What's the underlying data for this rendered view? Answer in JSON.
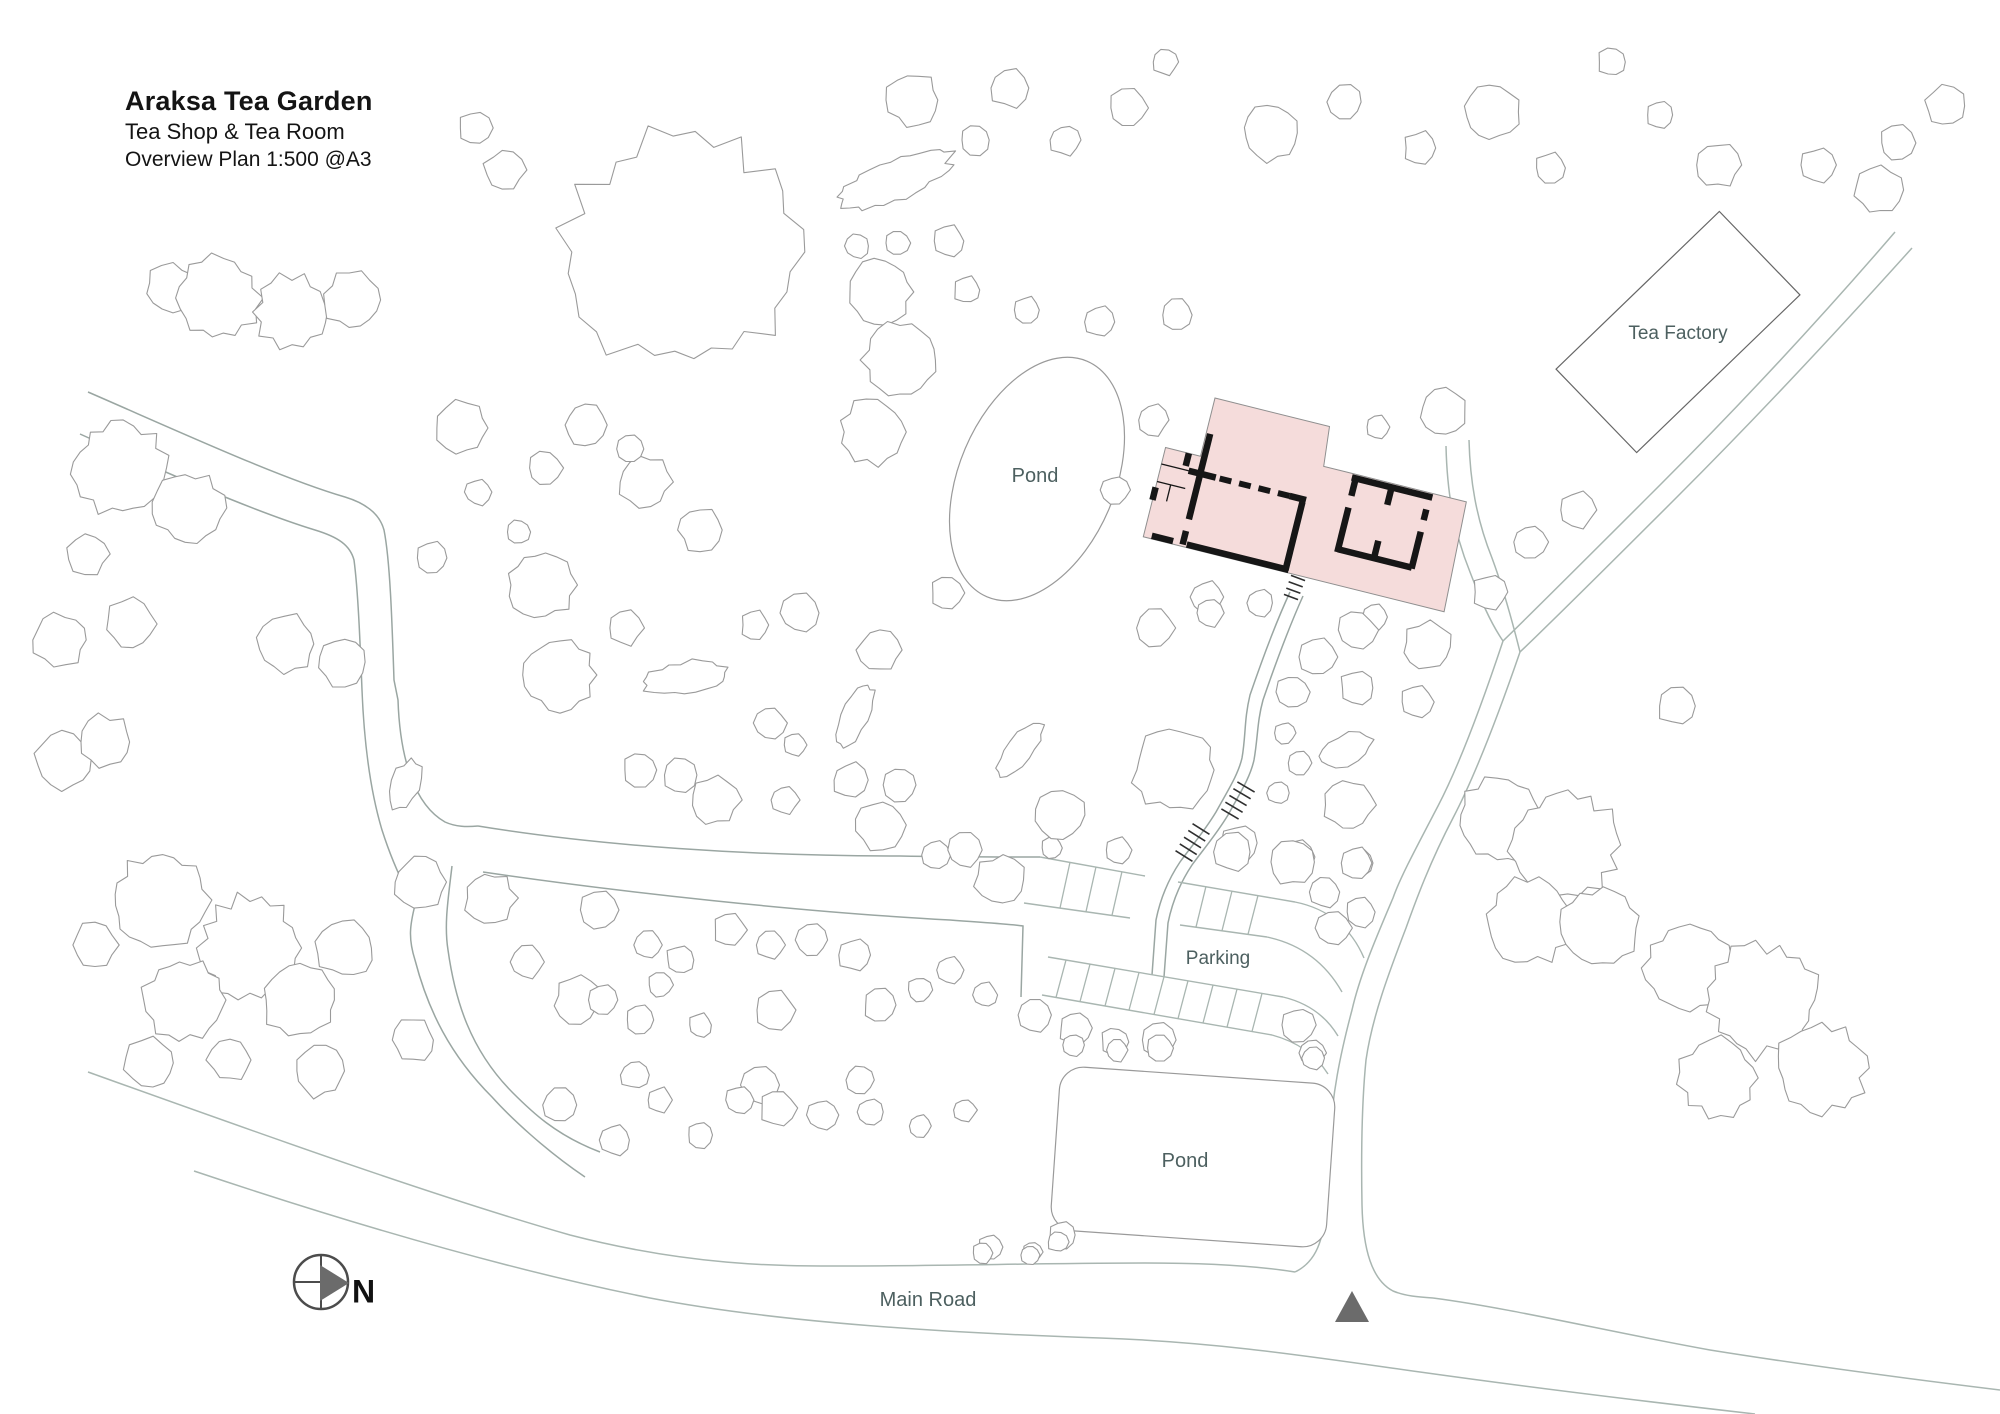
{
  "title_block": {
    "line1": "Araksa Tea Garden",
    "line2": "Tea Shop & Tea Room",
    "line3": "Overview Plan 1:500 @A3"
  },
  "colors": {
    "background": "#ffffff",
    "road": "#a9b6b1",
    "trail": "#9aa6a2",
    "tree": "#9a9a9a",
    "pond_outline": "#9a9a9a",
    "building_fill": "#f5dcdb",
    "building_outline": "#8f8f8f",
    "wall": "#161616",
    "hatch": "#2f2f2f",
    "label": "#4d6060",
    "title": "#141414",
    "compass_stroke": "#4c4c4c",
    "compass_fill": "#6b6b6b",
    "factory_outline": "#666666",
    "marker_fill": "#6b6b6b"
  },
  "labels": [
    {
      "name": "pond-upper-label",
      "text": "Pond",
      "x": 1035,
      "y": 482,
      "size": 20
    },
    {
      "name": "pond-lower-label",
      "text": "Pond",
      "x": 1185,
      "y": 1167,
      "size": 20
    },
    {
      "name": "parking-label",
      "text": "Parking",
      "x": 1218,
      "y": 964,
      "size": 19
    },
    {
      "name": "main-road-label",
      "text": "Main Road",
      "x": 928,
      "y": 1306,
      "size": 20
    },
    {
      "name": "tea-factory-label",
      "text": "Tea Factory",
      "x": 1678,
      "y": 339,
      "size": 19
    }
  ],
  "compass": {
    "cx": 321,
    "cy": 1282,
    "r": 27,
    "lines": [
      [
        294,
        1282,
        323,
        1282
      ],
      [
        321,
        1256,
        321,
        1308
      ]
    ],
    "triangle": "320,1265 349,1283 320,1301",
    "letter": "N",
    "letter_x": 352,
    "letter_y": 1294,
    "letter_size": 32
  },
  "entrance_marker": {
    "points": "1335,1322 1352,1291 1369,1322"
  },
  "ponds": {
    "upper": {
      "cx": 1037,
      "cy": 479,
      "rx": 78,
      "ry": 128,
      "rot": 23
    },
    "lower": {
      "cx": 1193,
      "cy": 1157,
      "w": 276,
      "h": 164,
      "rx": 24,
      "rot": 4
    }
  },
  "factory": {
    "cx": 1678,
    "cy": 332,
    "w": 227,
    "h": 116,
    "rot": -44
  },
  "building": {
    "transform": "translate(1215,398) rotate(14)",
    "footprint": "0,0 118,0 122,40 146,40 269,40 274,152 -36,152 -36,60 0,60",
    "walls_thick": [
      "M 4,36 L 4,124",
      "M 4,136 L 4,150",
      "M -8,77 L 20,77",
      "M 96,77 L 113,77",
      "M 110,80 L 110,150",
      "M -28,149 L -6,149",
      "M 8,149 L 113,149",
      "M -12,60 L -12,73",
      "M -36,101 L -36,114",
      "M 152,44 L 235,44",
      "M 156,44 L 156,62",
      "M 156,74 L 156,120",
      "M 156,117 L 232,117",
      "M 232,57 L 232,68",
      "M 232,80 L 232,118",
      "M 193,44 L 193,62",
      "M 193,99 L 193,118"
    ],
    "walls_thin": [
      "M -36,77 L -8,77",
      "M -36,95 L -7,95",
      "M -22,95 L -22,112"
    ],
    "dashed_wall": {
      "d": "M 24,77 L 96,77",
      "dash": "12 8"
    }
  },
  "roads": {
    "paths": [
      {
        "name": "main-road-top-left",
        "d": "M 88,1072 C 250,1130 430,1195 570,1235 C 690,1266 780,1266 835,1266 C 940,1266 1050,1263 1145,1263 C 1210,1263 1258,1266 1295,1272"
      },
      {
        "name": "main-road-top-right",
        "d": "M 1433,1298 C 1510,1308 1610,1332 1710,1350 C 1810,1366 1910,1379 2000,1390"
      },
      {
        "name": "main-road-bottom",
        "d": "M 194,1171 C 340,1220 500,1268 650,1298 C 780,1323 950,1333 1100,1338 C 1220,1342 1320,1358 1420,1372 C 1520,1386 1650,1402 1755,1414"
      },
      {
        "name": "access-road-west-edge",
        "d": "M 1503,641 C 1485,695 1462,760 1438,806 C 1415,850 1400,878 1393,898 C 1376,938 1360,975 1352,1010 C 1340,1055 1332,1095 1330,1140 L 1326,1205"
      },
      {
        "name": "access-road-east-edge",
        "d": "M 1520,652 C 1500,710 1477,772 1453,818 C 1430,862 1416,900 1406,928 C 1388,975 1372,1018 1366,1060 C 1362,1100 1361,1150 1362,1205"
      },
      {
        "name": "junction-flare-left",
        "d": "M 1326,1205 C 1324,1240 1316,1262 1295,1272"
      },
      {
        "name": "junction-flare-right",
        "d": "M 1362,1205 C 1363,1250 1372,1280 1393,1291 C 1405,1296 1418,1297 1433,1298"
      },
      {
        "name": "factory-road-nw-edge",
        "d": "M 1503,641 C 1545,600 1600,545 1660,485 C 1730,415 1815,325 1895,232"
      },
      {
        "name": "factory-road-se-edge",
        "d": "M 1520,652 C 1562,612 1617,557 1677,497 C 1747,427 1832,337 1912,248"
      },
      {
        "name": "building-drive-west",
        "d": "M 1446,446 C 1447,490 1453,530 1470,572 C 1480,598 1490,622 1503,641"
      },
      {
        "name": "building-drive-east",
        "d": "M 1469,440 C 1470,480 1476,518 1492,558 C 1502,585 1510,612 1520,652"
      },
      {
        "name": "west-trail-north-edge",
        "d": "M 88,392 C 180,432 280,478 345,497 C 368,504 380,515 384,530 C 390,560 392,620 394,680 L 398,700 C 400,760 415,805 445,822 C 456,827 467,827 478,826",
        "trail": true
      },
      {
        "name": "west-trail-south-edge",
        "d": "M 80,434 C 160,470 250,510 315,530 C 338,537 350,545 354,560 C 358,590 360,640 362,690 C 364,740 370,790 382,830 C 390,855 400,880 415,905",
        "trail": true
      },
      {
        "name": "west-trail-sw-branch-west",
        "d": "M 415,905 C 410,925 408,938 415,960 C 428,1010 450,1055 492,1097 C 510,1117 545,1150 585,1177",
        "trail": true
      },
      {
        "name": "west-trail-sw-branch-east",
        "d": "M 452,866 C 448,900 444,925 448,950 C 455,1000 470,1050 513,1093 C 530,1110 555,1135 600,1152",
        "trail": true
      },
      {
        "name": "east-branch-top",
        "d": "M 478,826 C 600,846 750,856 900,856 C 950,857 1000,857 1040,857",
        "trail": true
      },
      {
        "name": "east-branch-bottom",
        "d": "M 483,872 C 620,892 800,912 950,920 C 990,923 1010,924 1023,926 L 1021,997",
        "trail": true
      },
      {
        "name": "walkway-left-edge",
        "d": "M 1290,592 C 1277,620 1262,660 1250,695 C 1244,720 1246,735 1242,758 C 1238,775 1228,790 1216,812 C 1204,832 1190,848 1180,862 C 1168,880 1160,900 1156,920 L 1152,975",
        "trail": true
      },
      {
        "name": "walkway-right-edge",
        "d": "M 1303,596 C 1290,625 1275,665 1263,700 C 1257,722 1258,737 1254,760 C 1250,778 1240,793 1228,815 C 1216,835 1202,851 1192,865 C 1180,883 1172,903 1168,923 L 1164,977",
        "trail": true
      }
    ]
  },
  "parking": {
    "edges": [
      "M 1040,857 L 1145,876",
      "M 1178,882 L 1295,902",
      "M 1024,903 L 1130,918",
      "M 1180,925 L 1267,937",
      "M 1048,957 L 1283,997",
      "M 1042,995 L 1272,1035",
      "M 1295,902 C 1330,909 1352,930 1364,958",
      "M 1267,937 C 1300,944 1325,962 1342,992",
      "M 1283,997 C 1308,1003 1326,1016 1338,1036",
      "M 1272,1035 C 1298,1042 1316,1055 1328,1074"
    ],
    "bands": [
      {
        "top": [
          1040,
          857,
          1295,
          902
        ],
        "bottom": [
          1024,
          903,
          1267,
          937
        ],
        "xs": [
          1060,
          1086,
          1112,
          1196,
          1222,
          1248
        ],
        "lean": 10
      },
      {
        "top": [
          1048,
          957,
          1283,
          997
        ],
        "bottom": [
          1042,
          995,
          1272,
          1035
        ],
        "xs": [
          1056,
          1080,
          1105,
          1129,
          1154,
          1178,
          1203,
          1227,
          1252
        ],
        "lean": 10
      }
    ]
  },
  "hatches": [
    {
      "x1": 1246,
      "y1": 787,
      "x2": 1230,
      "y2": 814,
      "n": 5,
      "len": 20
    },
    {
      "x1": 1201,
      "y1": 829,
      "x2": 1184,
      "y2": 856,
      "n": 5,
      "len": 20
    },
    {
      "x1": 1298,
      "y1": 578,
      "x2": 1291,
      "y2": 597,
      "n": 4,
      "len": 15
    },
    {
      "x1": 1302,
      "y1": 516,
      "x2": 1307,
      "y2": 531,
      "n": 4,
      "len": 12
    }
  ],
  "trees": [
    [
      170,
      288,
      24
    ],
    [
      218,
      298,
      40
    ],
    [
      292,
      312,
      36
    ],
    [
      352,
      300,
      28
    ],
    [
      120,
      468,
      46
    ],
    [
      188,
      508,
      34
    ],
    [
      88,
      554,
      20
    ],
    [
      60,
      640,
      26
    ],
    [
      130,
      624,
      24
    ],
    [
      287,
      644,
      28
    ],
    [
      342,
      662,
      24
    ],
    [
      462,
      428,
      26
    ],
    [
      478,
      492,
      13
    ],
    [
      432,
      558,
      16
    ],
    [
      518,
      532,
      12
    ],
    [
      65,
      760,
      28
    ],
    [
      105,
      742,
      26
    ],
    [
      160,
      900,
      46
    ],
    [
      250,
      948,
      50
    ],
    [
      185,
      1000,
      40
    ],
    [
      300,
      1000,
      36
    ],
    [
      345,
      948,
      28
    ],
    [
      95,
      945,
      22
    ],
    [
      150,
      1063,
      24
    ],
    [
      230,
      1060,
      21
    ],
    [
      320,
      1071,
      25
    ],
    [
      413,
      1040,
      21
    ],
    [
      405,
      785,
      14,
      26,
      20
    ],
    [
      420,
      882,
      25
    ],
    [
      490,
      898,
      25
    ],
    [
      527,
      962,
      16
    ],
    [
      578,
      1000,
      23
    ],
    [
      540,
      585,
      33
    ],
    [
      560,
      675,
      36
    ],
    [
      585,
      425,
      21
    ],
    [
      645,
      482,
      25
    ],
    [
      545,
      468,
      17
    ],
    [
      700,
      530,
      21
    ],
    [
      684,
      252,
      114
    ],
    [
      505,
      170,
      20
    ],
    [
      475,
      128,
      17
    ],
    [
      895,
      180,
      60,
      20,
      -22
    ],
    [
      913,
      100,
      26
    ],
    [
      975,
      140,
      15
    ],
    [
      857,
      246,
      12
    ],
    [
      897,
      243,
      12
    ],
    [
      949,
      241,
      15
    ],
    [
      967,
      290,
      13
    ],
    [
      880,
      292,
      32
    ],
    [
      900,
      360,
      36
    ],
    [
      872,
      432,
      32
    ],
    [
      630,
      449,
      14
    ],
    [
      1010,
      88,
      19
    ],
    [
      1065,
      140,
      15
    ],
    [
      1128,
      108,
      19
    ],
    [
      1165,
      62,
      13
    ],
    [
      1270,
      133,
      27
    ],
    [
      1345,
      102,
      17
    ],
    [
      1420,
      148,
      16
    ],
    [
      1492,
      112,
      28
    ],
    [
      1550,
      168,
      15
    ],
    [
      1612,
      62,
      14
    ],
    [
      1660,
      115,
      13
    ],
    [
      1718,
      165,
      22
    ],
    [
      1818,
      165,
      17
    ],
    [
      1897,
      143,
      17
    ],
    [
      1878,
      190,
      23
    ],
    [
      1945,
      106,
      20
    ],
    [
      1027,
      310,
      13
    ],
    [
      1100,
      322,
      15
    ],
    [
      1177,
      315,
      16
    ],
    [
      1153,
      420,
      15
    ],
    [
      1115,
      490,
      14
    ],
    [
      1378,
      427,
      11
    ],
    [
      1443,
      412,
      23
    ],
    [
      1577,
      510,
      18
    ],
    [
      1530,
      542,
      17
    ],
    [
      1490,
      592,
      17
    ],
    [
      1677,
      706,
      19
    ],
    [
      1207,
      597,
      16
    ],
    [
      1260,
      603,
      13
    ],
    [
      1375,
      617,
      13
    ],
    [
      1155,
      628,
      19
    ],
    [
      1210,
      613,
      14
    ],
    [
      1318,
      657,
      18
    ],
    [
      1357,
      630,
      19
    ],
    [
      1427,
      647,
      24
    ],
    [
      1293,
      692,
      16
    ],
    [
      1357,
      688,
      17
    ],
    [
      1417,
      702,
      16
    ],
    [
      1175,
      770,
      40
    ],
    [
      1285,
      733,
      11
    ],
    [
      1300,
      763,
      12
    ],
    [
      1345,
      750,
      28,
      15,
      -20
    ],
    [
      1278,
      793,
      11
    ],
    [
      1348,
      805,
      25
    ],
    [
      1240,
      843,
      18
    ],
    [
      1297,
      857,
      18
    ],
    [
      1360,
      863,
      13
    ],
    [
      1325,
      892,
      15
    ],
    [
      1500,
      820,
      42
    ],
    [
      1565,
      845,
      52
    ],
    [
      1530,
      920,
      42
    ],
    [
      1600,
      928,
      38
    ],
    [
      1690,
      968,
      44
    ],
    [
      1762,
      1000,
      54
    ],
    [
      1822,
      1068,
      44
    ],
    [
      1718,
      1078,
      38
    ],
    [
      1052,
      848,
      11
    ],
    [
      1118,
      850,
      13
    ],
    [
      1232,
      852,
      19
    ],
    [
      1293,
      862,
      22
    ],
    [
      1357,
      863,
      16
    ],
    [
      1360,
      912,
      15
    ],
    [
      1333,
      928,
      17
    ],
    [
      1075,
      1028,
      16
    ],
    [
      1115,
      1042,
      14
    ],
    [
      1158,
      1040,
      17
    ],
    [
      1298,
      1025,
      17
    ],
    [
      1312,
      1053,
      13
    ],
    [
      1073,
      1045,
      11
    ],
    [
      1117,
      1050,
      11
    ],
    [
      1160,
      1048,
      13
    ],
    [
      1313,
      1058,
      11
    ],
    [
      1062,
      1235,
      13
    ],
    [
      990,
      1247,
      12
    ],
    [
      1032,
      1252,
      10
    ],
    [
      1058,
      1242,
      10
    ],
    [
      625,
      628,
      17
    ],
    [
      755,
      625,
      14
    ],
    [
      800,
      613,
      19
    ],
    [
      880,
      650,
      21
    ],
    [
      947,
      593,
      16
    ],
    [
      685,
      678,
      42,
      16,
      -8
    ],
    [
      855,
      715,
      13,
      34,
      25
    ],
    [
      1020,
      750,
      13,
      32,
      40
    ],
    [
      770,
      723,
      16
    ],
    [
      795,
      745,
      11
    ],
    [
      640,
      770,
      17
    ],
    [
      680,
      775,
      17
    ],
    [
      715,
      800,
      24
    ],
    [
      785,
      800,
      14
    ],
    [
      850,
      780,
      17
    ],
    [
      900,
      785,
      17
    ],
    [
      880,
      825,
      24
    ],
    [
      935,
      855,
      14
    ],
    [
      965,
      850,
      17
    ],
    [
      1000,
      880,
      24
    ],
    [
      1060,
      815,
      24
    ],
    [
      600,
      910,
      19
    ],
    [
      648,
      945,
      14
    ],
    [
      680,
      960,
      14
    ],
    [
      660,
      985,
      12
    ],
    [
      603,
      1000,
      15
    ],
    [
      640,
      1020,
      14
    ],
    [
      700,
      1025,
      12
    ],
    [
      730,
      930,
      16
    ],
    [
      770,
      945,
      14
    ],
    [
      775,
      1010,
      19
    ],
    [
      812,
      940,
      16
    ],
    [
      855,
      955,
      16
    ],
    [
      880,
      1005,
      16
    ],
    [
      920,
      990,
      12
    ],
    [
      950,
      970,
      14
    ],
    [
      985,
      995,
      12
    ],
    [
      1035,
      1015,
      16
    ],
    [
      635,
      1075,
      14
    ],
    [
      760,
      1085,
      19
    ],
    [
      860,
      1080,
      14
    ],
    [
      560,
      1105,
      17
    ],
    [
      615,
      1140,
      15
    ],
    [
      660,
      1100,
      12
    ],
    [
      700,
      1135,
      13
    ],
    [
      740,
      1100,
      14
    ],
    [
      778,
      1108,
      18
    ],
    [
      822,
      1115,
      15
    ],
    [
      870,
      1112,
      13
    ],
    [
      920,
      1126,
      11
    ],
    [
      965,
      1110,
      11
    ],
    [
      983,
      1253,
      10
    ],
    [
      1030,
      1255,
      9
    ]
  ]
}
